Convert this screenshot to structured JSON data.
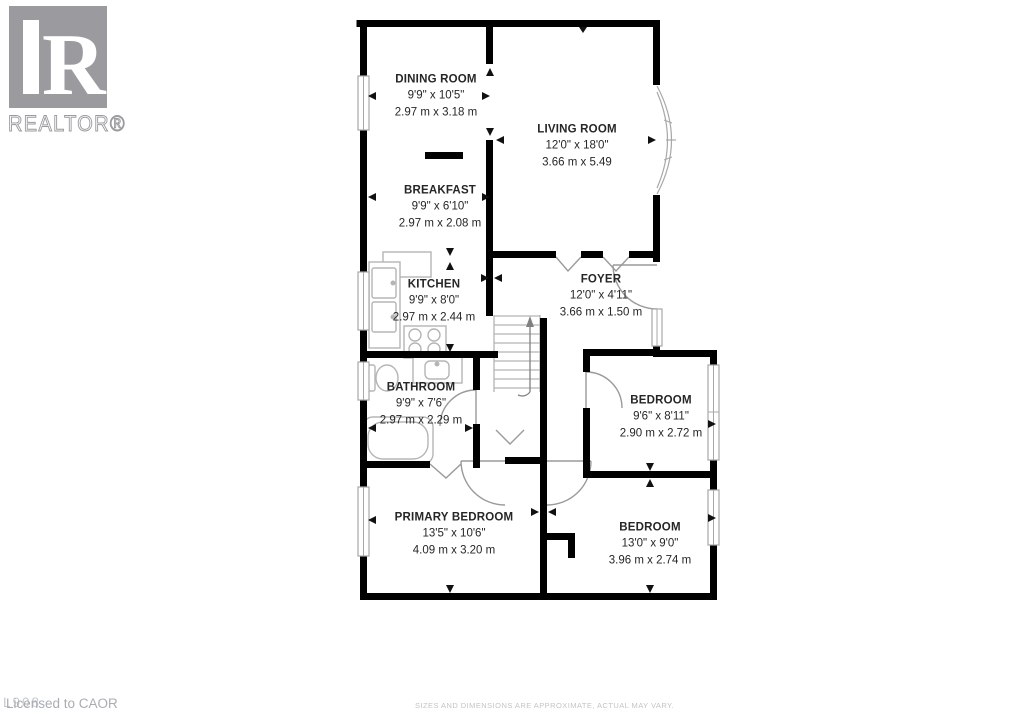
{
  "branding": {
    "logo_letter": "R",
    "logo_name": "REALTOR®",
    "logo_color": "#9b9b9f"
  },
  "rooms": [
    {
      "id": "dining-room",
      "name": "DINING ROOM",
      "imperial": "9'9\" x 10'5\"",
      "metric": "2.97 m x 3.18 m"
    },
    {
      "id": "living-room",
      "name": "LIVING ROOM",
      "imperial": "12'0\" x 18'0\"",
      "metric": "3.66 m x 5.49"
    },
    {
      "id": "breakfast",
      "name": "BREAKFAST",
      "imperial": "9'9\" x 6'10\"",
      "metric": "2.97 m x 2.08 m"
    },
    {
      "id": "kitchen",
      "name": "KITCHEN",
      "imperial": "9'9\" x 8'0\"",
      "metric": "2.97 m x 2.44 m"
    },
    {
      "id": "foyer",
      "name": "FOYER",
      "imperial": "12'0\" x 4'11\"",
      "metric": "3.66 m x 1.50 m"
    },
    {
      "id": "bathroom",
      "name": "BATHROOM",
      "imperial": "9'9\" x 7'6\"",
      "metric": "2.97 m x 2.29 m"
    },
    {
      "id": "bedroom-1",
      "name": "BEDROOM",
      "imperial": "9'6\" x 8'11\"",
      "metric": "2.90 m x 2.72 m"
    },
    {
      "id": "primary-bedroom",
      "name": "PRIMARY BEDROOM",
      "imperial": "13'5\" x 10'6\"",
      "metric": "4.09 m x 3.20 m"
    },
    {
      "id": "bedroom-2",
      "name": "BEDROOM",
      "imperial": "13'0\" x 9'0\"",
      "metric": "3.96 m x 2.74 m"
    }
  ],
  "footer": {
    "licensed": "Licensed to CAOR",
    "overlay": "L908",
    "disclaimer": "SIZES AND DIMENSIONS ARE APPROXIMATE, ACTUAL MAY VARY."
  },
  "colors": {
    "wall": "#000000",
    "fixture": "#b5b5b5",
    "door": "#9a9a9a",
    "label_text": "#262626",
    "footer_text": "#a9adb3",
    "disclaimer_text": "#c4c4c4"
  }
}
